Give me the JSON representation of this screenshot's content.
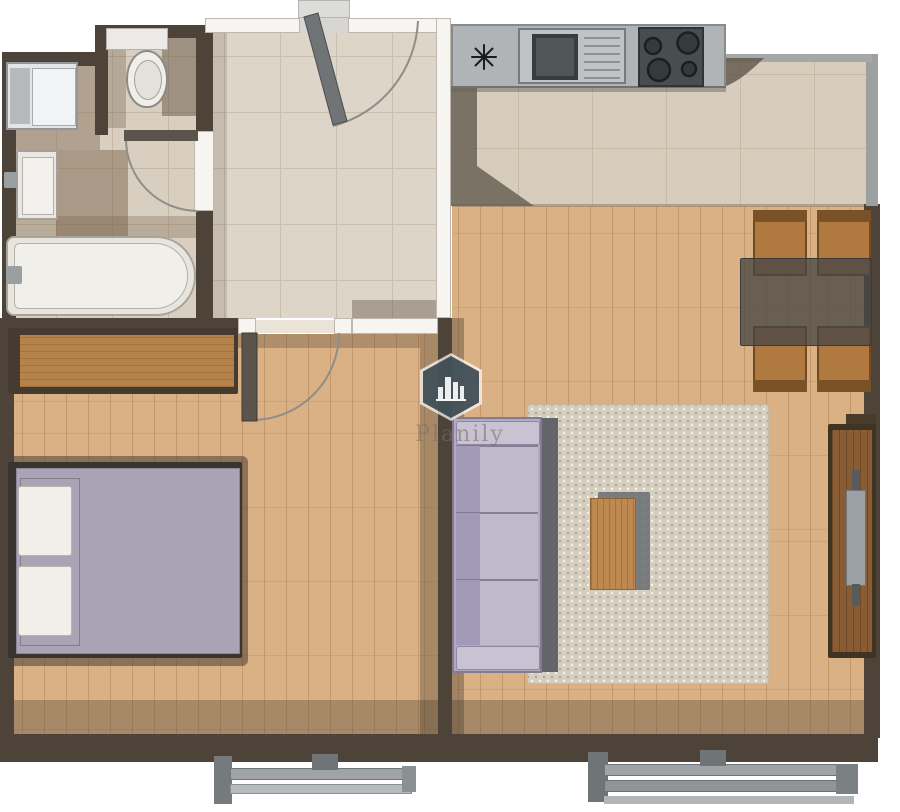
{
  "watermark": {
    "text": "Planily",
    "icon": "planily-hexagon-city-logo-icon"
  },
  "palette": {
    "background": "#ffffff",
    "wall_dark": "#4d4339",
    "wall_light": "#f6f5f1",
    "bath_tile": "#d8cfc0",
    "hall_tile": "#ddd5c7",
    "kitchen_tile": "#d7cdbd",
    "wood_floor": "#dab184",
    "counter_gray": "#b0b4b6",
    "appliance_dark": "#474e50",
    "sofa_lavender": "#b2aac0",
    "bed_blanket": "#aaa3b6",
    "rug_beige": "#d6cfc0",
    "chair_wood": "#b0793f",
    "tv_stand_wood": "#8a5c33",
    "shadow_brown": "#5a4c3e"
  },
  "rooms": {
    "bathroom": {
      "fixtures": [
        "washing-machine",
        "bathroom-sink",
        "bathtub",
        "toilet",
        "toilet-cistern"
      ]
    },
    "hallway": {
      "fixtures": [
        "entrance-door",
        "bathroom-door",
        "bedroom-door"
      ]
    },
    "kitchen": {
      "fixtures": [
        "kitchen-counter",
        "kitchen-sink",
        "drainboard",
        "cooktop-4-burners",
        "star-symbol"
      ]
    },
    "living_room": {
      "fixtures": [
        "sofa-3-seat",
        "area-rug",
        "coffee-table",
        "dining-table",
        "dining-chairs-4",
        "tv-stand",
        "tv",
        "balcony-door"
      ]
    },
    "bedroom": {
      "fixtures": [
        "double-bed",
        "pillows-2",
        "dresser",
        "window"
      ]
    }
  }
}
